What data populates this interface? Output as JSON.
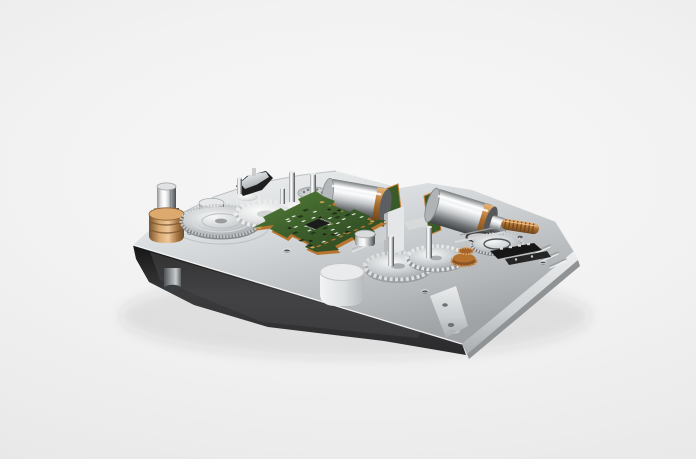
{
  "image": {
    "kind": "3D product render",
    "description": "Electromechanical micro gear-drive assembly mounted on a machined aluminum baseplate, shown in three-quarter perspective on a plain light-gray studio background. No text, UI or watermark is visible.",
    "background": {
      "center_color": "#f7f7f7",
      "edge_color": "#e4e4e4"
    }
  },
  "objects": {
    "baseplate": {
      "label": "machined aluminum baseplate",
      "top_color": "#d2d5d7",
      "shadow_side_color": "#2e2e2e",
      "lit_side_color": "#dfe2e3"
    },
    "foot_pin": {
      "label": "cylindrical locating foot under left tip"
    },
    "brass_bushing": {
      "label": "brass bushing with chrome hex drive shaft",
      "color": "#c08a52"
    },
    "left_disc_gear": {
      "label": "large polished steel disc gear with fine teeth"
    },
    "drum": {
      "label": "chrome drum behind left gear"
    },
    "white_gears": {
      "label": "light plastic spur gears beside PCB"
    },
    "bracket": {
      "label": "black switch bracket with metal cap"
    },
    "bearing_disc": {
      "label": "knurled bearing disc with planet dots"
    },
    "pins": {
      "label": "chrome shaft pins standing on plate"
    },
    "pcb": {
      "label": "green control PCB with SMD components",
      "board_color": "#3c5e2c",
      "edge_copper_color": "#c9833f",
      "chip_color": "#1b1b1b"
    },
    "motor_center": {
      "label": "chrome DC micromotor with copper winding ring"
    },
    "motor_right": {
      "label": "chrome DC micromotor with copper winding and output nose"
    },
    "mid_walls": {
      "label": "machined partition walls of center channel"
    },
    "front_boss": {
      "label": "rounded boss on front edge"
    },
    "corner_pocket": {
      "label": "milled pocket with bores at front corner"
    },
    "right_gear_large": {
      "label": "large steel spur gear on output shaft"
    },
    "right_gear_small": {
      "label": "meshing steel spur gear on shaft"
    },
    "flat_disc": {
      "label": "flat toothed encoder disc"
    },
    "copper_pinions": {
      "label": "copper pinion gear stack"
    },
    "worm_gear": {
      "label": "copper worm gear on motor shaft"
    },
    "connectors": {
      "label": "black electrical connector blocks"
    },
    "mounting_holes": {
      "label": "countersunk mounting holes in plate"
    }
  },
  "palette": {
    "chrome_light": "#f2f4f5",
    "chrome_mid": "#c6c9cb",
    "chrome_dark": "#6e7275",
    "brass": "#c08a52",
    "copper": "#b5722f",
    "pcb_green": "#3c5e2c",
    "black_part": "#1c1c1c"
  }
}
